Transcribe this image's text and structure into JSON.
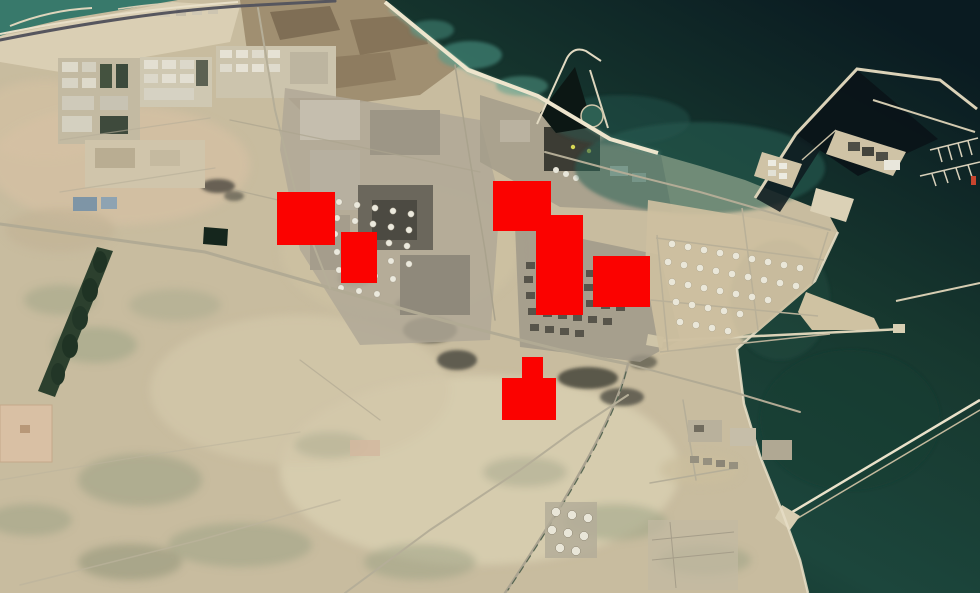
{
  "window": {
    "width": 980,
    "height": 593
  },
  "map": {
    "type": "satellite-imagery",
    "palette": {
      "sand_base": "#c8bc9f",
      "sand_light": "#d8cfb2",
      "sand_dark": "#9b8a6c",
      "scrub_green": "#9aa084",
      "beach": "#ece3cc",
      "sea_deep": "#0a1b21",
      "sea_mid": "#1c463c",
      "sea_coastal": "#38796b",
      "sea_shallow": "#4f9d8c",
      "harbor_basin": "#0b1418",
      "breakwater": "#dbd2b8",
      "road_light": "#b3ac96",
      "road_dark": "#56565e",
      "industry_light": "#b0a896",
      "industry_dark": "#4c4a42",
      "vegetation": "#2c402e",
      "tank_white": "#eae7d9"
    }
  },
  "overlay": {
    "marker_color": "#fb0200",
    "markers": [
      {
        "id": "highlight-marker-1",
        "x": 277,
        "y": 192,
        "width": 58,
        "height": 53
      },
      {
        "id": "highlight-marker-2",
        "x": 341,
        "y": 232,
        "width": 36,
        "height": 51
      },
      {
        "id": "highlight-marker-3",
        "x": 493,
        "y": 181,
        "width": 58,
        "height": 50
      },
      {
        "id": "highlight-marker-4",
        "x": 536,
        "y": 215,
        "width": 47,
        "height": 100
      },
      {
        "id": "highlight-marker-5",
        "x": 593,
        "y": 256,
        "width": 57,
        "height": 51
      },
      {
        "id": "highlight-marker-6",
        "x": 522,
        "y": 357,
        "width": 21,
        "height": 21
      },
      {
        "id": "highlight-marker-7",
        "x": 502,
        "y": 378,
        "width": 54,
        "height": 42
      }
    ]
  }
}
